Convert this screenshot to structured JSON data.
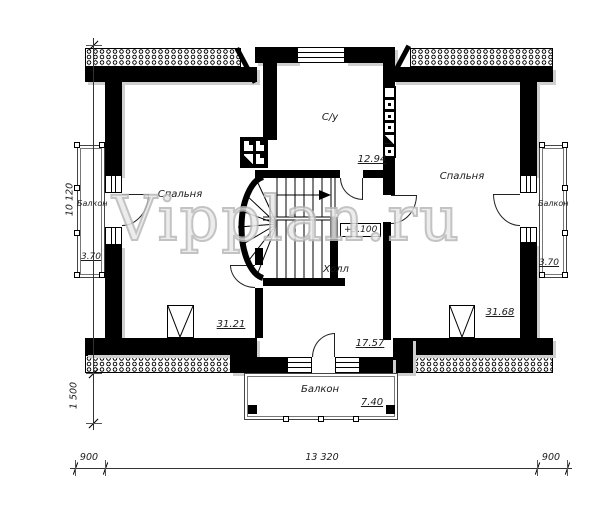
{
  "watermark": "Vipplan.ru",
  "level_mark": "+3.100",
  "rooms": {
    "bedroom_left": {
      "name": "Спальня",
      "area": "31.21"
    },
    "bedroom_right": {
      "name": "Спальня",
      "area": "31.68"
    },
    "bathroom": {
      "name": "С/у",
      "area": "12.94"
    },
    "hall": {
      "name": "Холл",
      "area": "17.57"
    },
    "balcony_left": {
      "name": "Балкон",
      "area": "3.70"
    },
    "balcony_right": {
      "name": "Балкон",
      "area": "3.70"
    },
    "balcony_bottom": {
      "name": "Балкон",
      "area": "7.40"
    }
  },
  "dimensions": {
    "left_total": "10 120",
    "left_balcony": "1 500",
    "bottom_left": "900",
    "bottom_total": "13 320",
    "bottom_right": "900"
  },
  "colors": {
    "wall": "#000000",
    "shadow": "#cfcfcf",
    "watermark_outline": "#b9b9b9"
  }
}
